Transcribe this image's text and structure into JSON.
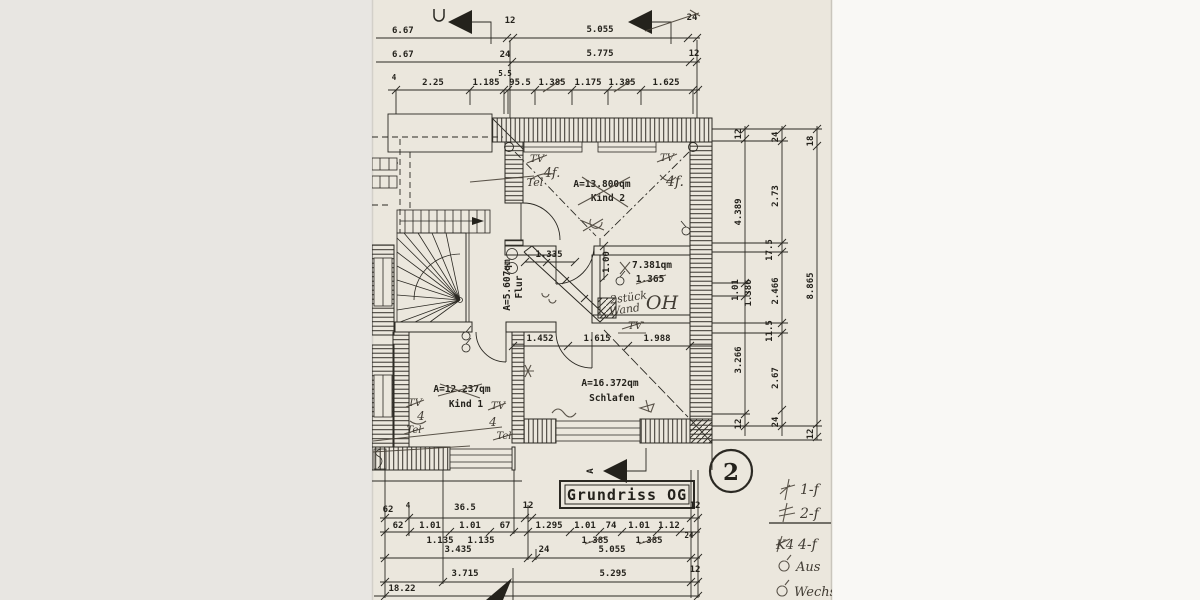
{
  "titleblock": {
    "title": "Grundriss OG",
    "sheet_no": "2",
    "section_marker": "A"
  },
  "rooms": {
    "kind2": {
      "area": "A=13.800qm",
      "name": "Kind 2"
    },
    "flur": {
      "area": "A=5.607qm",
      "name": "Flur"
    },
    "bad": {
      "area": "7.381qm",
      "sub": "1.365"
    },
    "schlafen": {
      "area": "A=16.372qm",
      "name": "Schlafen"
    },
    "kind1": {
      "area": "A=12.237qm",
      "name": "Kind 1"
    }
  },
  "pencil": {
    "kind2_tl": [
      "TV",
      "4f.",
      "Tel"
    ],
    "kind2_tr": [
      "TV",
      "4f."
    ],
    "wand_note": [
      "2stück",
      "Wand",
      "OH"
    ],
    "corridor_tv": "TV",
    "kind1_l": [
      "TV",
      "4",
      "Tel"
    ],
    "kind1_r": [
      "TV",
      "4",
      "Tel"
    ],
    "legend": [
      {
        "prefix": "",
        "label": "1-f"
      },
      {
        "prefix": "",
        "label": "2-f"
      },
      {
        "prefix": "K4",
        "label": "4-f"
      },
      {
        "prefix": "",
        "label": "Aus"
      },
      {
        "prefix": "",
        "label": "Wechse"
      }
    ]
  },
  "dims": {
    "top": {
      "r1": [
        "6.67",
        "12",
        "5.055",
        "24"
      ],
      "r2": [
        "6.67",
        "24",
        "5.775",
        "12"
      ],
      "r3": [
        "4",
        "2.25",
        "1.185",
        "5.5",
        "95.5",
        "1.385",
        "1.175",
        "1.385",
        "1.625"
      ]
    },
    "right": {
      "c1": [
        "12",
        "4.389",
        "1.01",
        "1.386",
        "3.266",
        "12"
      ],
      "c2": [
        "24",
        "2.73",
        "17.5",
        "2.466",
        "11.5",
        "2.67",
        "24"
      ],
      "c3": [
        "18",
        "8.865",
        "12"
      ]
    },
    "inner": [
      "1.335",
      "1.00",
      "1.452",
      "1.615",
      "1.988"
    ],
    "bottom": {
      "rA": [
        "62",
        "4",
        "36.5",
        "12",
        "12"
      ],
      "rB": [
        "62",
        "1.01",
        "1.01",
        "67",
        "1.295",
        "1.01",
        "74",
        "1.01",
        "1.12"
      ],
      "rBsub": [
        "1.135",
        "1.135",
        "1.385",
        "1.385",
        "24"
      ],
      "rC": [
        "3.435",
        "24",
        "5.055"
      ],
      "rD": [
        "3.715",
        "5.295",
        "12"
      ],
      "rE": "18.22"
    }
  }
}
